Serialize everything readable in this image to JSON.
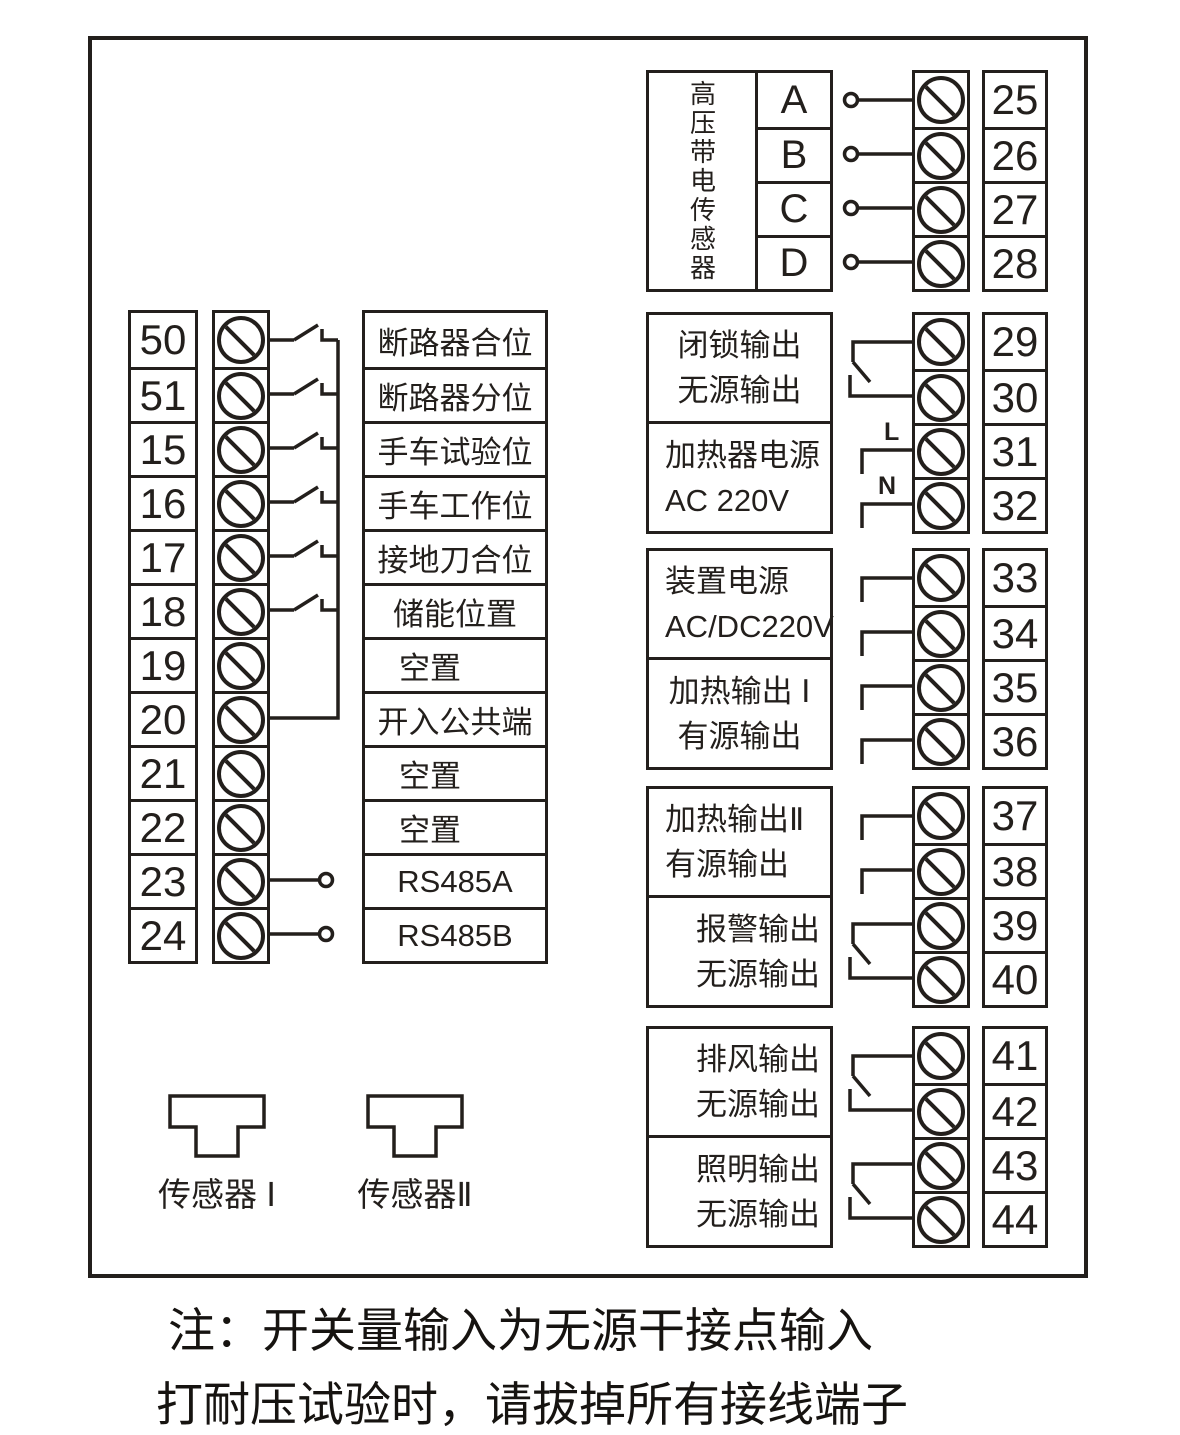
{
  "colors": {
    "ink": "#231f1c",
    "background": "#ffffff"
  },
  "left_block": {
    "rows": [
      {
        "t": "50",
        "label": "断路器合位"
      },
      {
        "t": "51",
        "label": "断路器分位"
      },
      {
        "t": "15",
        "label": "手车试验位"
      },
      {
        "t": "16",
        "label": "手车工作位"
      },
      {
        "t": "17",
        "label": "接地刀合位"
      },
      {
        "t": "18",
        "label": "储能位置"
      },
      {
        "t": "19",
        "label": "空置"
      },
      {
        "t": "20",
        "label": "开入公共端"
      },
      {
        "t": "21",
        "label": "空置"
      },
      {
        "t": "22",
        "label": "空置"
      },
      {
        "t": "23",
        "label": "RS485A"
      },
      {
        "t": "24",
        "label": "RS485B"
      }
    ]
  },
  "hv_block": {
    "title": "高压带电传感器",
    "phases": [
      {
        "name": "A",
        "t": "25"
      },
      {
        "name": "B",
        "t": "26"
      },
      {
        "name": "C",
        "t": "27"
      },
      {
        "name": "D",
        "t": "28"
      }
    ]
  },
  "outputs": [
    {
      "line1": "闭锁输出",
      "line2": "无源输出",
      "t1": "29",
      "t2": "30"
    },
    {
      "line1": "加热器电源",
      "line2": "AC 220V",
      "t1": "31",
      "t2": "32",
      "mark1": "L",
      "mark2": "N"
    },
    {
      "line1": "装置电源",
      "line2": "AC/DC220V",
      "t1": "33",
      "t2": "34"
    },
    {
      "line1": "加热输出 Ⅰ",
      "line2": "有源输出",
      "t1": "35",
      "t2": "36"
    },
    {
      "line1": "加热输出Ⅱ",
      "line2": "有源输出",
      "t1": "37",
      "t2": "38"
    },
    {
      "line1": "报警输出",
      "line2": "无源输出",
      "t1": "39",
      "t2": "40"
    },
    {
      "line1": "排风输出",
      "line2": "无源输出",
      "t1": "41",
      "t2": "42"
    },
    {
      "line1": "照明输出",
      "line2": "无源输出",
      "t1": "43",
      "t2": "44"
    }
  ],
  "sensors": {
    "sensor1": "传感器 Ⅰ",
    "sensor2": "传感器Ⅱ"
  },
  "note": {
    "line1": "注：开关量输入为无源干接点输入",
    "line2": "打耐压试验时，请拔掉所有接线端子"
  }
}
